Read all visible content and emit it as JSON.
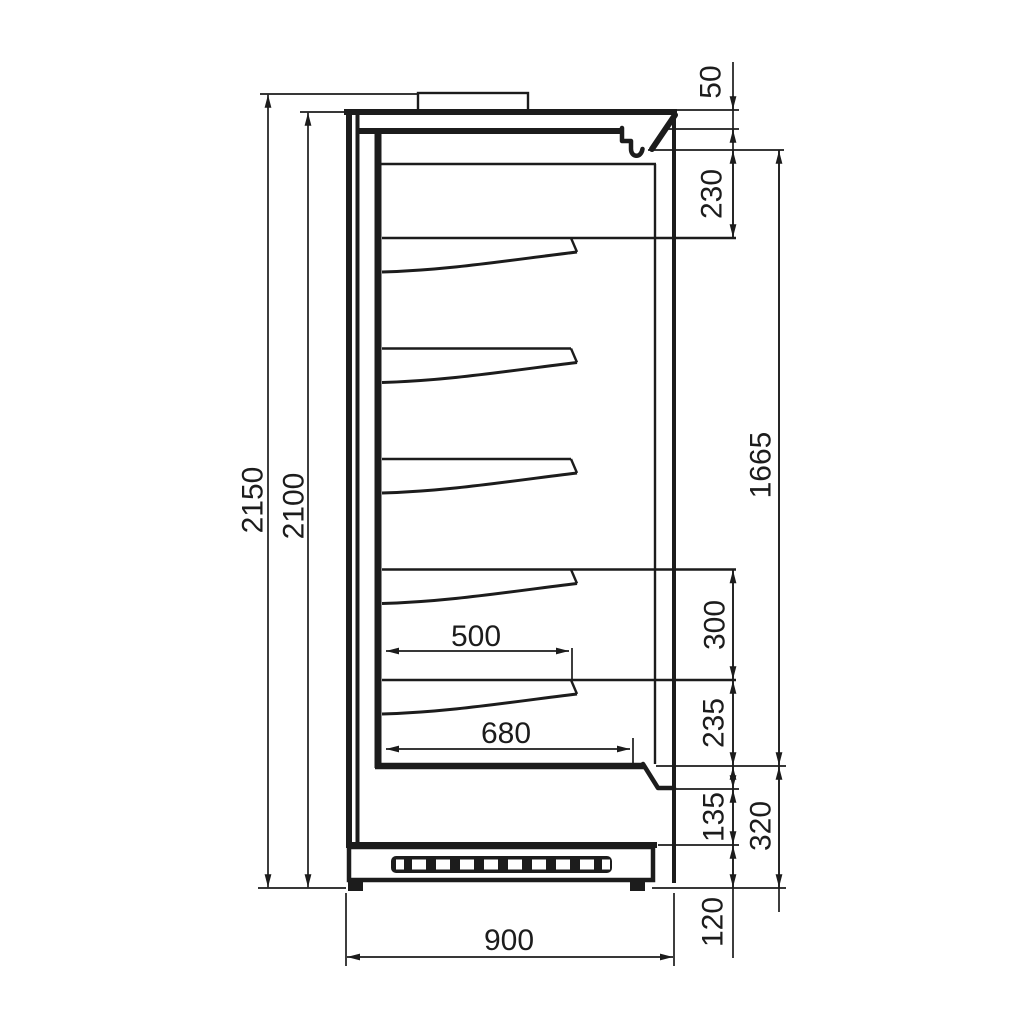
{
  "drawing": {
    "type": "technical-side-section",
    "subject": "multideck refrigerated display case - side profile with dimension chains",
    "units": "mm",
    "shelf_count": 5,
    "style": {
      "line_color": "#1c1c1c",
      "background": "#ffffff"
    },
    "dimensions": {
      "overall_height": "2150",
      "body_height": "2100",
      "canopy_front_height": "50",
      "canopy_to_first_shelf": "230",
      "display_opening_height": "1665",
      "bottom_shelf_spacing": "300",
      "shelf_to_deck": "235",
      "front_step_height": "135",
      "deck_to_floor": "320",
      "plinth_height": "120",
      "shelf_depth": "500",
      "deck_depth": "680",
      "overall_depth": "900"
    }
  }
}
